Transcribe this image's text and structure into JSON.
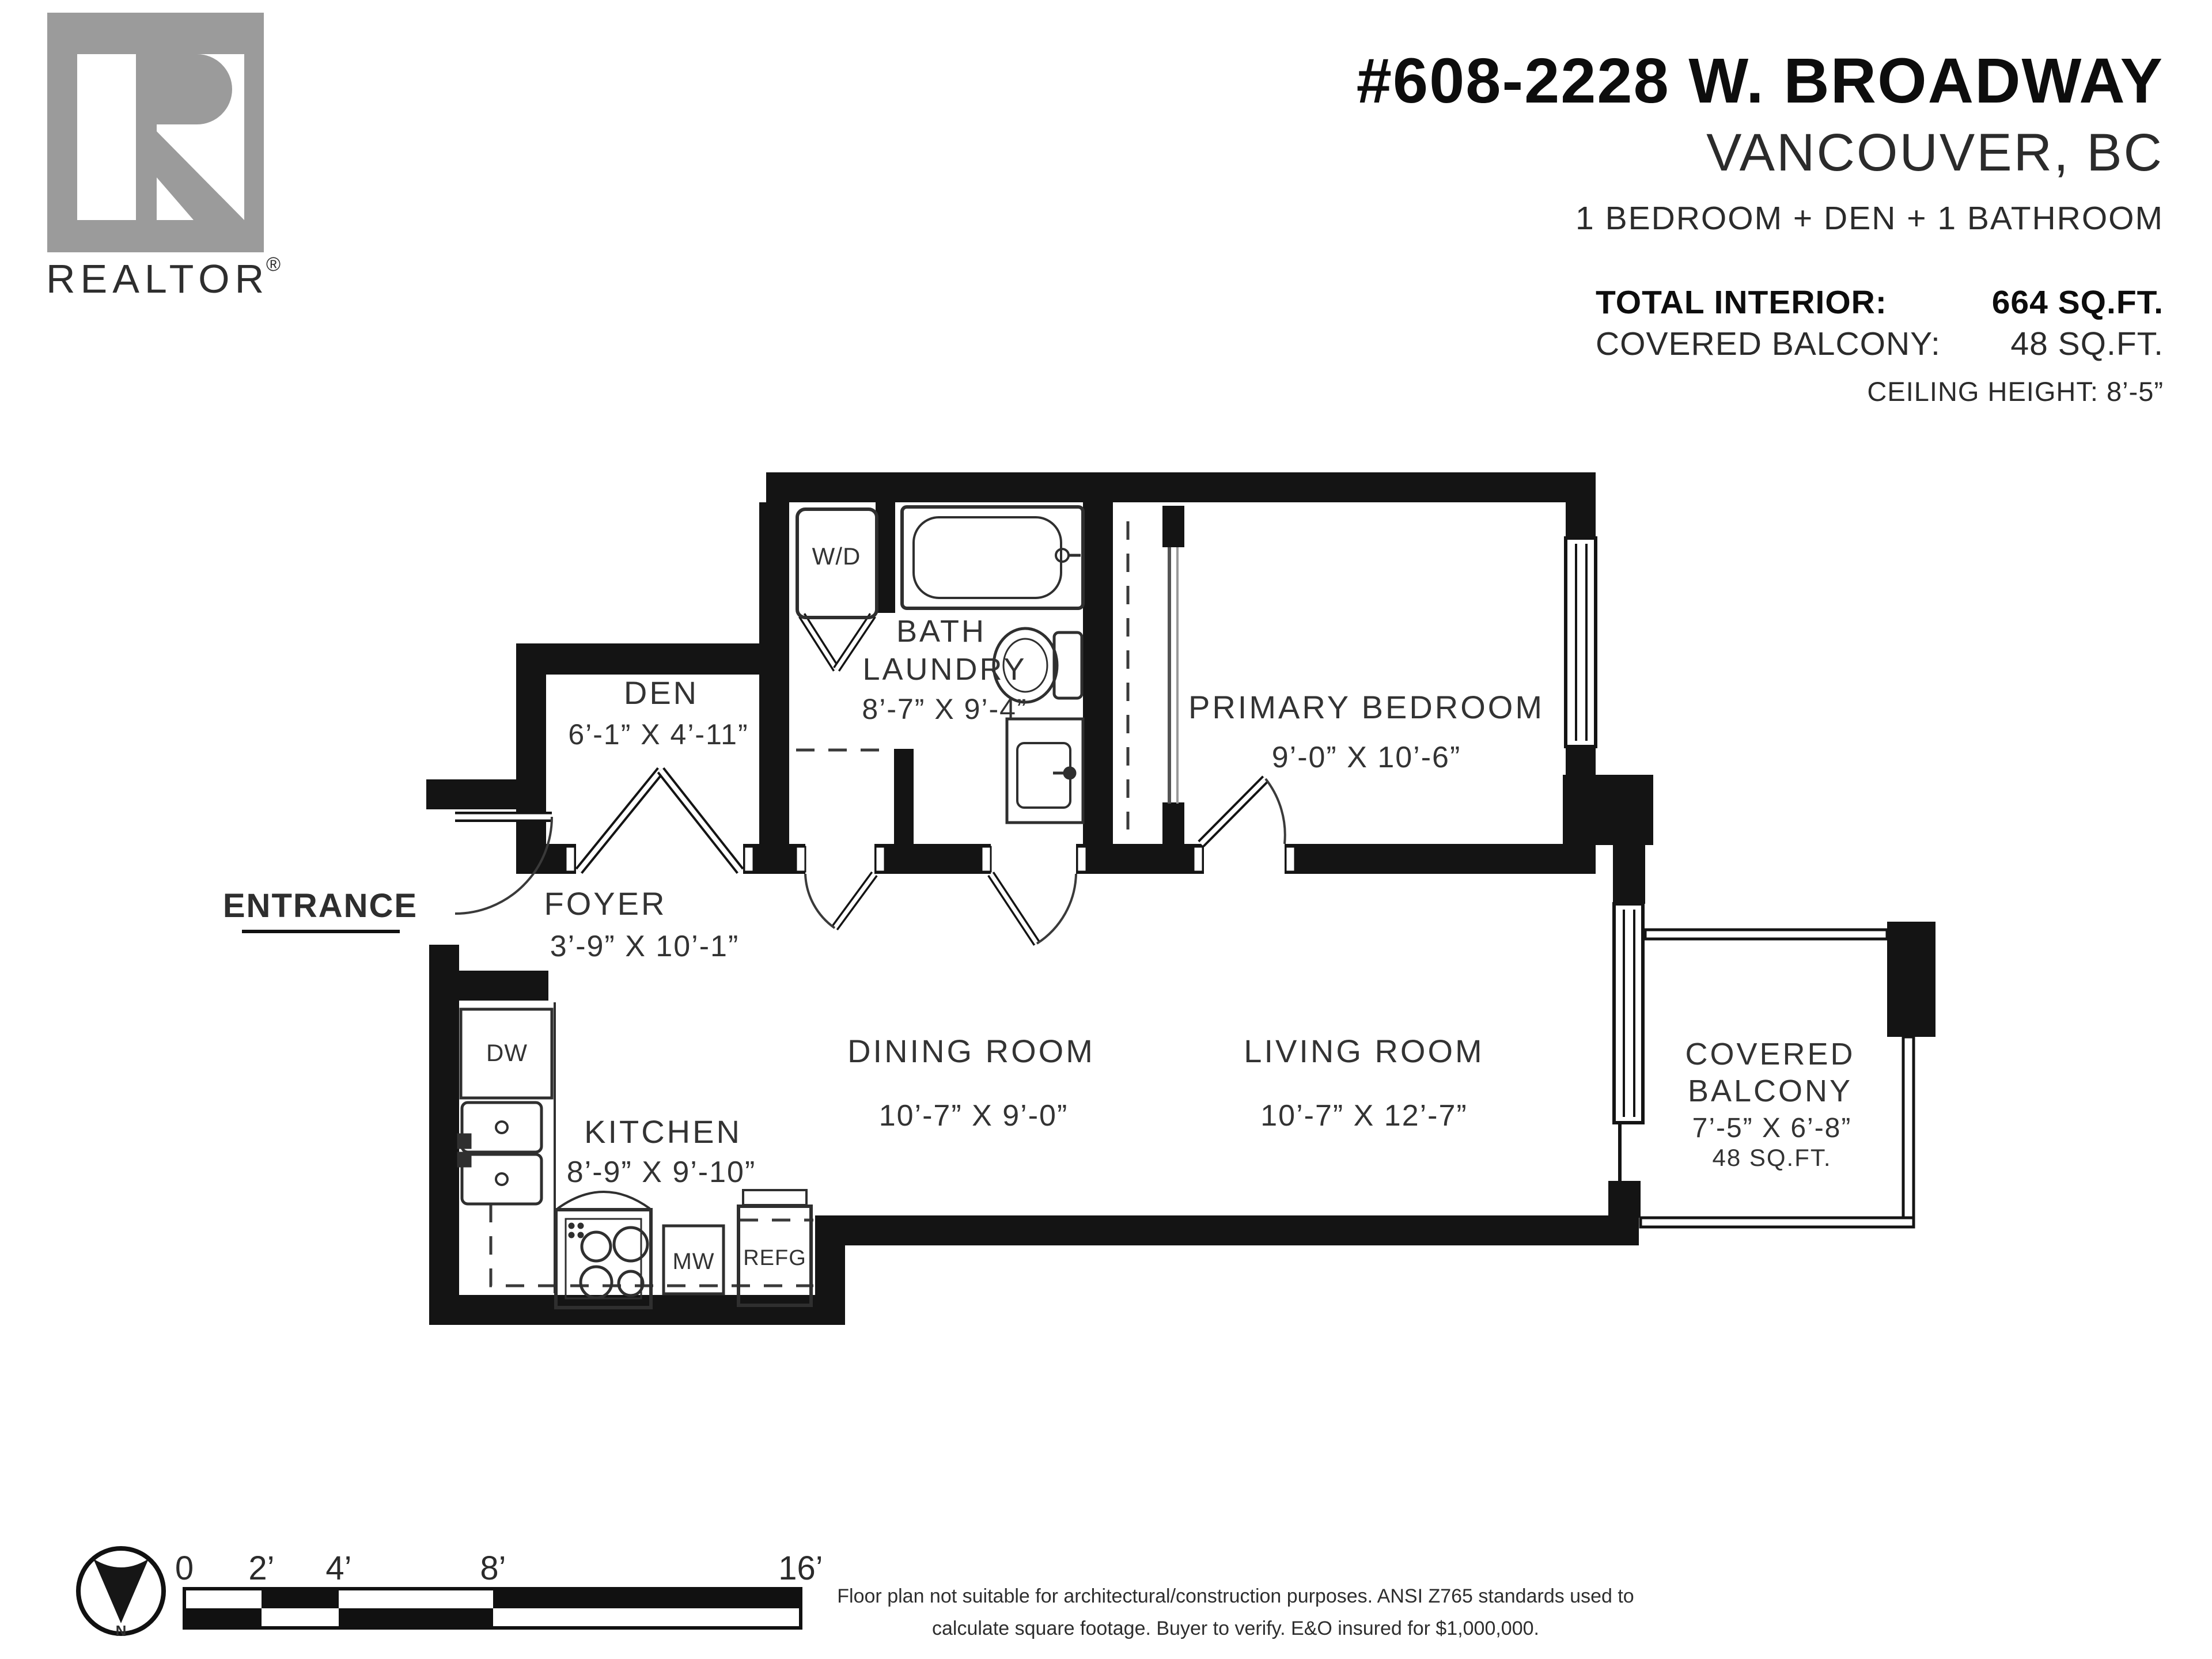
{
  "logo": {
    "brand": "REALTOR",
    "registered": "®",
    "color": "#9b9b9b"
  },
  "header": {
    "title": "#608-2228 W. BROADWAY",
    "city": "VANCOUVER, BC",
    "config": "1 BEDROOM + DEN + 1 BATHROOM",
    "stats": [
      {
        "label": "TOTAL INTERIOR:",
        "value": "664 SQ.FT."
      },
      {
        "label": "COVERED BALCONY:",
        "value": "48 SQ.FT."
      }
    ],
    "ceiling": "CEILING HEIGHT: 8’-5”"
  },
  "plan": {
    "entrance_label": "ENTRANCE",
    "rooms": {
      "den": {
        "name": "DEN",
        "dims": "6’-1” X 4’-11”"
      },
      "bath": {
        "line1": "BATH",
        "line2": "LAUNDRY",
        "dims": "8’-7” X 9’-4”"
      },
      "primary_bedroom": {
        "name": "PRIMARY BEDROOM",
        "dims": "9’-0” X 10’-6”"
      },
      "foyer": {
        "name": "FOYER",
        "dims": "3’-9” X 10’-1”"
      },
      "kitchen": {
        "name": "KITCHEN",
        "dims": "8’-9” X 9’-10”"
      },
      "dining": {
        "name": "DINING ROOM",
        "dims": "10’-7” X 9’-0”"
      },
      "living": {
        "name": "LIVING ROOM",
        "dims": "10’-7” X 12’-7”"
      },
      "balcony": {
        "line1": "COVERED",
        "line2": "BALCONY",
        "dims": "7’-5” X 6’-8”",
        "area": "48 SQ.FT."
      }
    },
    "appliances": {
      "washer_dryer": "W/D",
      "dishwasher": "DW",
      "microwave": "MW",
      "fridge": "REFG"
    }
  },
  "footer": {
    "compass_north": "N",
    "scale_ticks": [
      "0",
      "2’",
      "4’",
      "8’",
      "16’"
    ],
    "disclaimer_line1": "Floor plan not suitable for architectural/construction purposes. ANSI Z765 standards used to",
    "disclaimer_line2": "calculate square footage. Buyer to verify.  E&O insured for $1,000,000."
  },
  "colors": {
    "wall": "#141414",
    "label": "#333333",
    "logo_gray": "#9b9b9b"
  }
}
